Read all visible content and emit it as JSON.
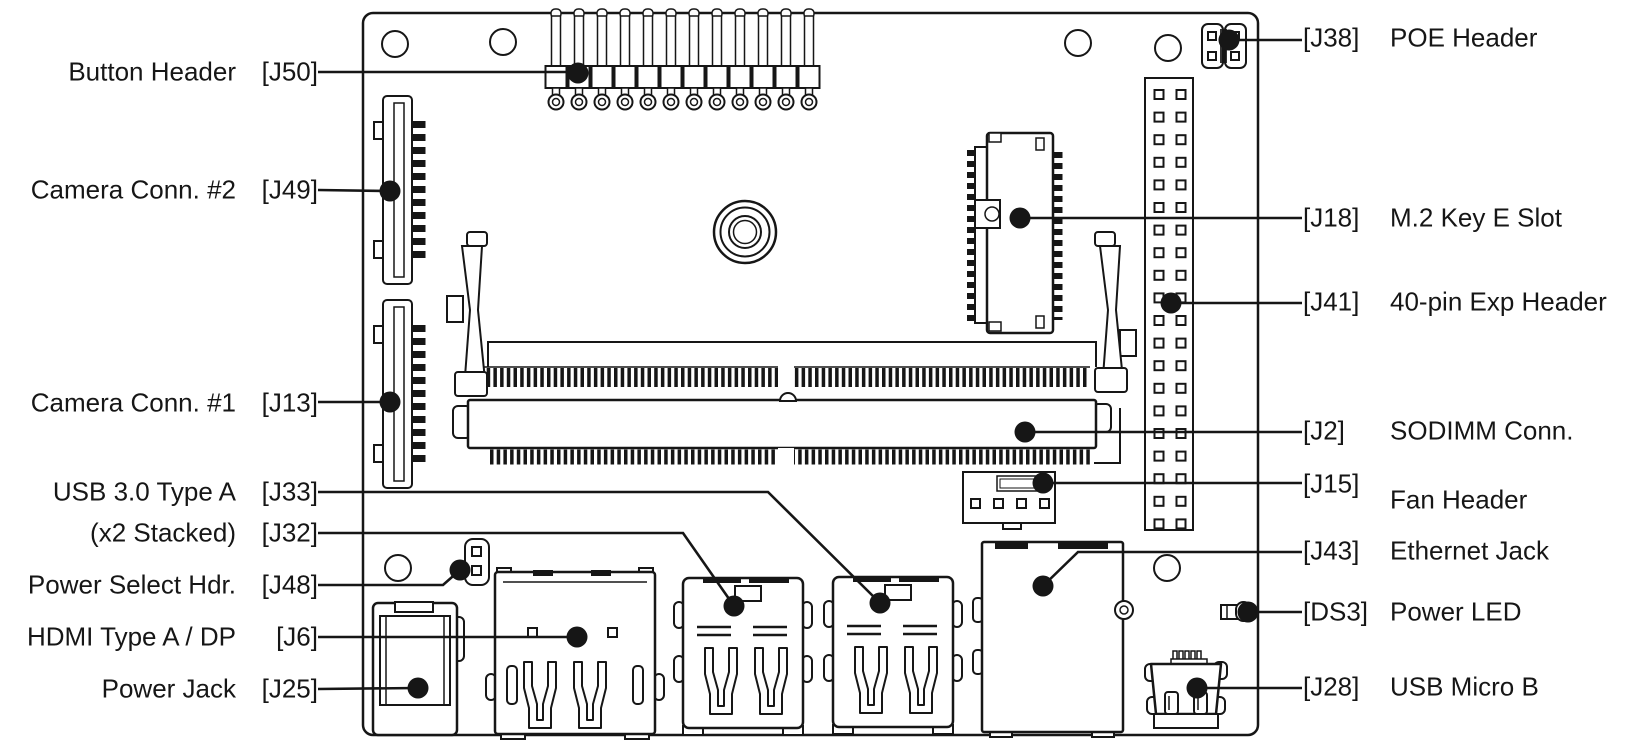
{
  "diagram": {
    "type": "board-connector-callout-diagram",
    "colors": {
      "line": "#161616",
      "background": "#ffffff"
    },
    "callouts_left": [
      {
        "name": "Button Header",
        "ref": "[J50]"
      },
      {
        "name": "Camera Conn. #2",
        "ref": "[J49]"
      },
      {
        "name": "Camera Conn. #1",
        "ref": "[J13]"
      },
      {
        "name": "USB 3.0 Type A",
        "ref": "[J33]"
      },
      {
        "name": "(x2 Stacked)",
        "ref": "[J32]"
      },
      {
        "name": "Power Select Hdr.",
        "ref": "[J48]"
      },
      {
        "name": "HDMI Type A / DP",
        "ref": "[J6]"
      },
      {
        "name": "Power Jack",
        "ref": "[J25]"
      }
    ],
    "callouts_right": [
      {
        "ref": "[J38]",
        "name": "POE Header"
      },
      {
        "ref": "[J18]",
        "name": "M.2 Key E Slot"
      },
      {
        "ref": "[J41]",
        "name": "40-pin Exp Header"
      },
      {
        "ref": "[J2]",
        "name": "SODIMM Conn."
      },
      {
        "ref": "[J15]",
        "name": "Fan Header"
      },
      {
        "ref": "[J43]",
        "name": "Ethernet Jack"
      },
      {
        "ref": "[DS3]",
        "name": "Power LED"
      },
      {
        "ref": "[J28]",
        "name": "USB Micro B"
      }
    ]
  }
}
